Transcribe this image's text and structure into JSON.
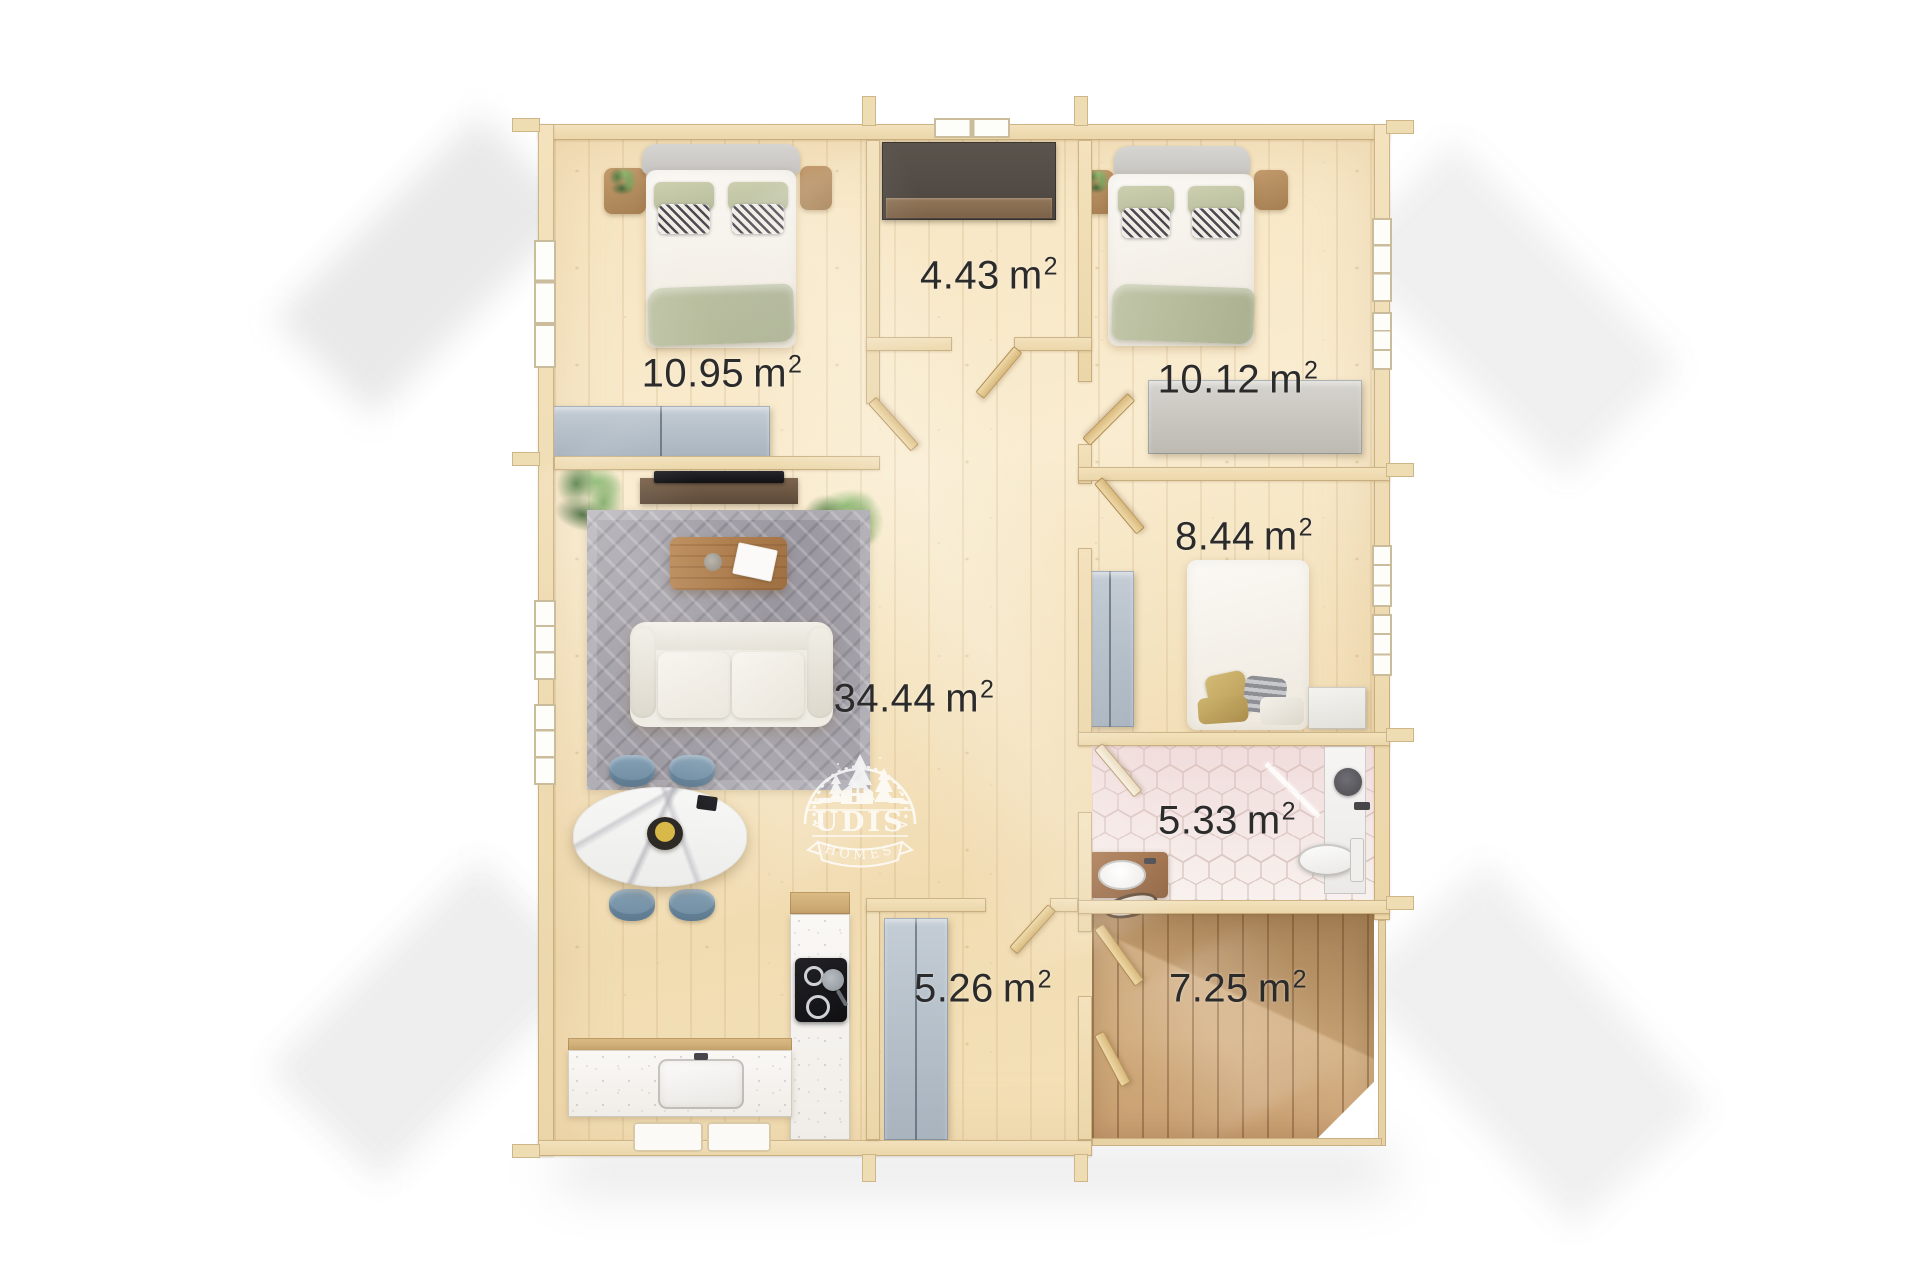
{
  "watermark": {
    "chevron_left": "<",
    "brand": "UDIS",
    "chevron_right": ">",
    "sub": "HOMES",
    "color": "#ffffff"
  },
  "unit": {
    "base": "m",
    "sup": "2"
  },
  "rooms": [
    {
      "id": "bedroom-top-left",
      "area": "10.95"
    },
    {
      "id": "hallway-top",
      "area": "4.43"
    },
    {
      "id": "bedroom-top-right",
      "area": "10.12"
    },
    {
      "id": "bedroom-small",
      "area": "8.44"
    },
    {
      "id": "living-kitchen",
      "area": "34.44"
    },
    {
      "id": "bathroom",
      "area": "5.33"
    },
    {
      "id": "entrance-hall",
      "area": "5.26"
    },
    {
      "id": "terrace",
      "area": "7.25"
    }
  ],
  "palette": {
    "label_text": "#2b2b2b",
    "wood_floor": "#f5e3bd",
    "wall": "#f0ddb5",
    "terrace_deck": "#cba677",
    "bathroom_tile": "#f6efec",
    "wardrobe": "#b6c0ca",
    "sofa": "#efece4",
    "chair": "#7e96aa",
    "counter": "#f7f5f1",
    "stove": "#1e1e22",
    "watermark": "#ffffff"
  }
}
